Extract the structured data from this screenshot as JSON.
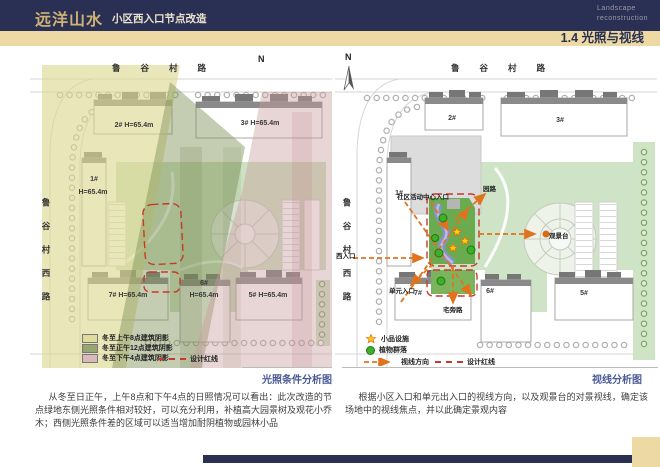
{
  "header": {
    "title": "远洋山水",
    "subtitle": "小区西入口节点改造",
    "brand_line1": "Landscape",
    "brand_line2": "reconstruction",
    "section": "1.4 光照与视线",
    "navy": "#2a3054",
    "tan": "#ecd9a3"
  },
  "left_diagram": {
    "caption": "光照条件分析图",
    "north": "N",
    "street_top": "鲁谷村路",
    "street_left": "鲁谷村西路",
    "buildings": [
      {
        "label": "2#",
        "height": "H=65.4m"
      },
      {
        "label": "3#",
        "height": "H=65.4m"
      },
      {
        "label": "1#",
        "height": "H=65.4m"
      },
      {
        "label": "7#",
        "height": "H=65.4m"
      },
      {
        "label": "6#",
        "height": "H=65.4m"
      },
      {
        "label": "5#",
        "height": "H=65.4m"
      }
    ],
    "legend": [
      {
        "label": "冬至上午8点建筑阴影",
        "color": "#dfdc9b"
      },
      {
        "label": "冬至正午12点建筑阴影",
        "color": "#97a571"
      },
      {
        "label": "冬至下午4点建筑阴影",
        "color": "#d9b9b9"
      }
    ],
    "redline_label": "设计红线"
  },
  "right_diagram": {
    "caption": "视线分析图",
    "north": "N",
    "street_top": "鲁谷村路",
    "street_left": "鲁谷村西路",
    "buildings": [
      {
        "label": "2#"
      },
      {
        "label": "3#"
      },
      {
        "label": "1#"
      },
      {
        "label": "7#"
      },
      {
        "label": "6#"
      },
      {
        "label": "5#"
      }
    ],
    "labels": {
      "community_entrance": "社区活动中心入口",
      "garden_path": "园路",
      "west_entrance": "西入口",
      "viewing_platform": "观景台",
      "unit_entrance": "单元入口",
      "residence_path": "宅旁路"
    },
    "legend": {
      "facility": "小品设施",
      "plants": "植物群落",
      "sight": "视线方向",
      "redline": "设计红线"
    },
    "colors": {
      "sight_orange": "#e0731d",
      "redline_red": "#c6392b",
      "node_green": "#68a94f",
      "facility_yellow": "#ffd400",
      "plant_green": "#3fae2a"
    }
  },
  "paragraphs": {
    "left": "从冬至日正午，上午8点和下午4点的日照情况可以看出：此次改造的节点绿地东侧光照条件相对较好，可以充分利用，补植高大园景树及观花小乔木；西侧光照条件差的区域可以适当增加耐阴植物或园林小品",
    "right": "根据小区入口和单元出入口的视线方向，以及观景台的对景视线，确定该场地中的视线焦点，并以此确定景观内容"
  }
}
